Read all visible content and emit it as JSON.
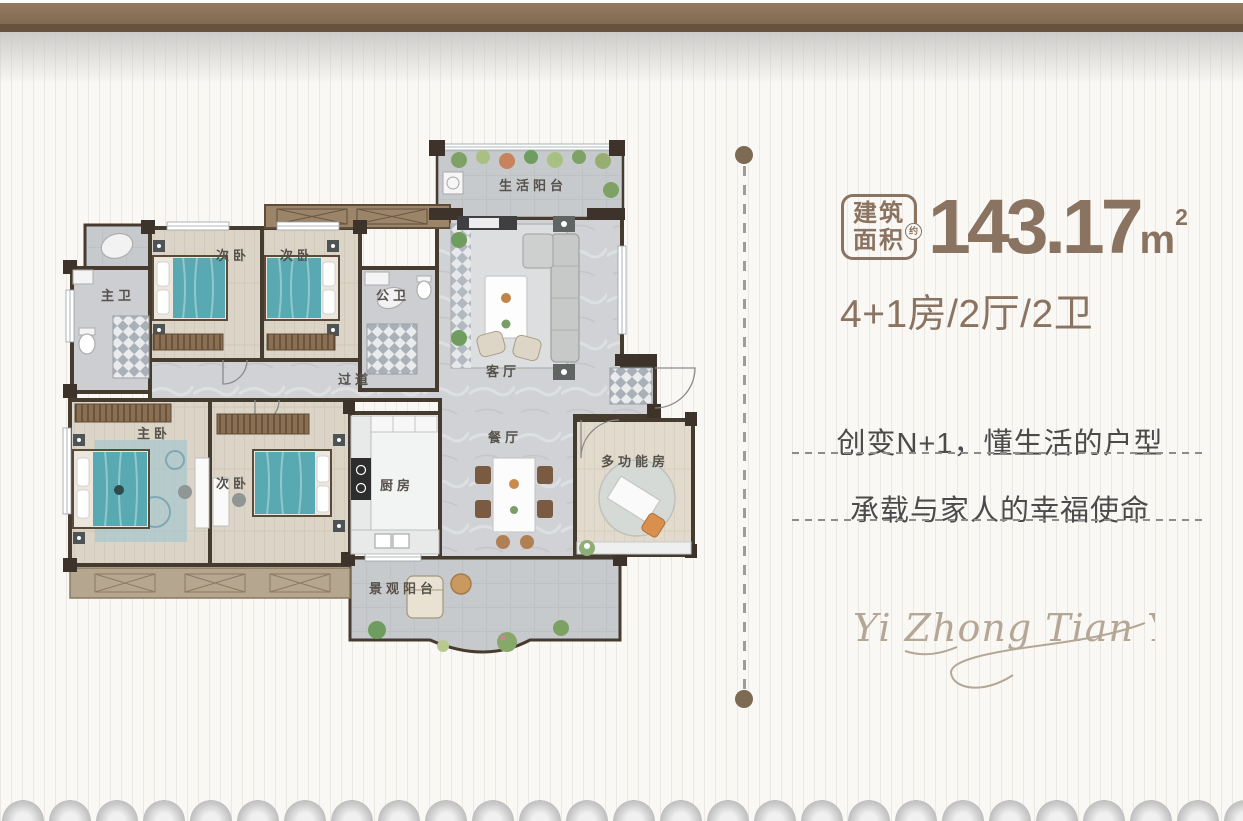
{
  "area": {
    "badge_line1": "建筑",
    "badge_line2": "面积",
    "badge_approx": "约",
    "value": "143.17",
    "unit": "m",
    "unit_exp": "2"
  },
  "layout_spec": "4+1房/2厅/2卫",
  "slogans": [
    {
      "text": "创变N+1，懂生活的户型"
    },
    {
      "text": "承载与家人的幸福使命"
    }
  ],
  "signature": "Yi Zhong Tian Yue",
  "floorplan": {
    "rooms": [
      {
        "id": "life-balcony",
        "label": "生活阳台"
      },
      {
        "id": "living-room",
        "label": "客厅"
      },
      {
        "id": "bedroom-2",
        "label": "次卧"
      },
      {
        "id": "bedroom-3",
        "label": "次卧"
      },
      {
        "id": "master-bath",
        "label": "主卫"
      },
      {
        "id": "public-bath",
        "label": "公卫"
      },
      {
        "id": "hallway",
        "label": "过道"
      },
      {
        "id": "master-bedroom",
        "label": "主卧"
      },
      {
        "id": "bedroom-4",
        "label": "次卧"
      },
      {
        "id": "kitchen",
        "label": "厨房"
      },
      {
        "id": "dining-room",
        "label": "餐厅"
      },
      {
        "id": "multi-function-room",
        "label": "多功能房"
      },
      {
        "id": "view-balcony",
        "label": "景观阳台"
      }
    ]
  },
  "colors": {
    "accent_brown": "#8a7360",
    "band_brown": "#8a7157",
    "band_dark": "#67523f",
    "wall_dark": "#463b2f",
    "bed_teal": "#58a9b1",
    "wood_floor": "#dcd5c7",
    "marble_floor": "#d0d2d5",
    "slogan_gray": "#4b4b4b",
    "signature_tan": "#b5a795"
  }
}
